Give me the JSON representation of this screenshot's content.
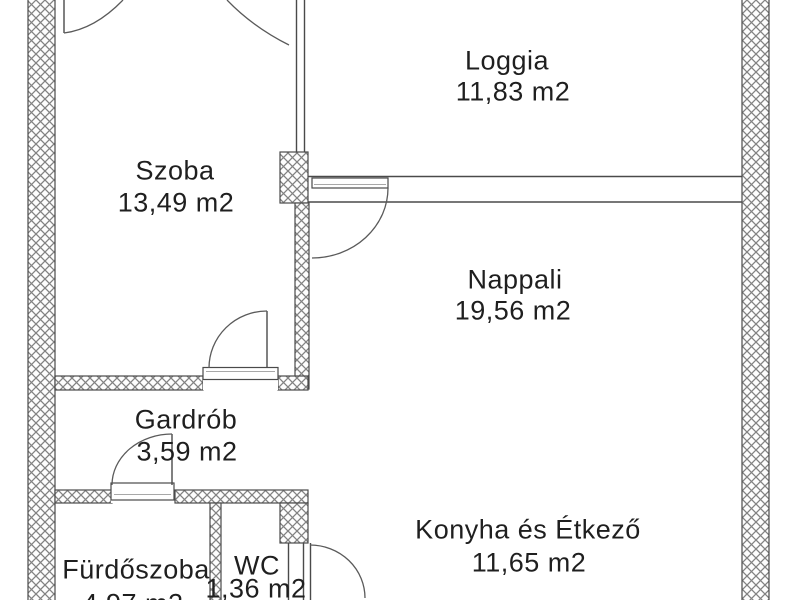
{
  "plan": {
    "title": "Apartment floor plan",
    "rooms": [
      {
        "name": "Szoba",
        "area": "13,49 m2"
      },
      {
        "name": "Loggia",
        "area": "11,83 m2"
      },
      {
        "name": "Nappali",
        "area": "19,56 m2"
      },
      {
        "name": "Gardrób",
        "area": "3,59 m2"
      },
      {
        "name": "Konyha és Étkező",
        "area": "11,65 m2"
      },
      {
        "name": "Fürdőszoba",
        "area": "4,97 m2"
      },
      {
        "name": "WC",
        "area": "1,36 m2"
      }
    ],
    "colors": {
      "background": "#ffffff",
      "wall_outline": "#4a4a4a",
      "hatch_line": "#828282",
      "text": "#1f1f1f"
    }
  }
}
